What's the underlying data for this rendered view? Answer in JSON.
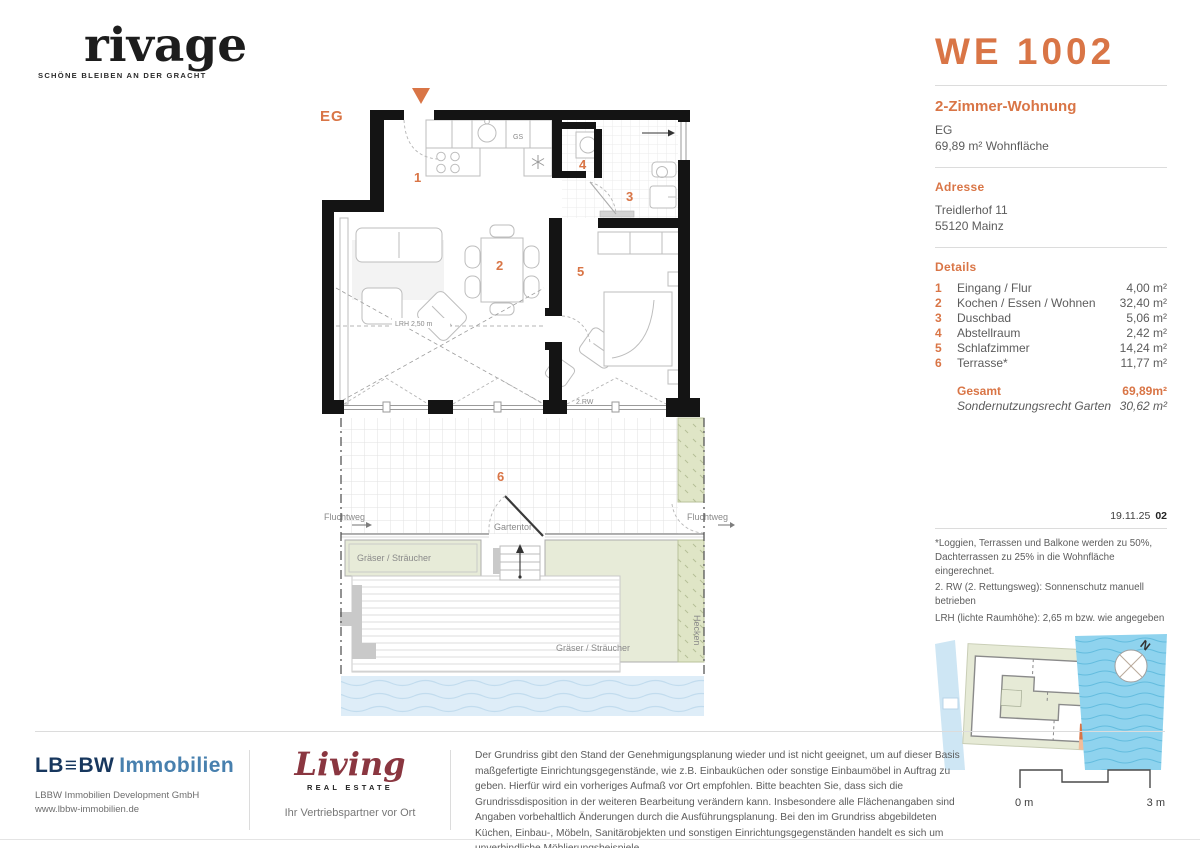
{
  "brand": {
    "name": "rivage",
    "tagline": "SCHÖNE BLEIBEN AN DER GRACHT"
  },
  "unit": {
    "id": "WE 1002",
    "type": "2-Zimmer-Wohnung",
    "floor": "EG",
    "area_line": "69,89 m² Wohnfläche"
  },
  "address": {
    "heading": "Adresse",
    "line1": "Treidlerhof 11",
    "line2": "55120 Mainz"
  },
  "details": {
    "heading": "Details",
    "rows": [
      {
        "num": "1",
        "name": "Eingang / Flur",
        "area": "4,00 m²"
      },
      {
        "num": "2",
        "name": "Kochen / Essen / Wohnen",
        "area": "32,40 m²"
      },
      {
        "num": "3",
        "name": "Duschbad",
        "area": "5,06 m²"
      },
      {
        "num": "4",
        "name": "Abstellraum",
        "area": "2,42 m²"
      },
      {
        "num": "5",
        "name": "Schlafzimmer",
        "area": "14,24 m²"
      },
      {
        "num": "6",
        "name": "Terrasse*",
        "area": "11,77 m²"
      }
    ],
    "total_label": "Gesamt",
    "total_value": "69,89m²",
    "special_label": "Sondernutzungsrecht Garten",
    "special_value": "30,62 m²"
  },
  "meta": {
    "date": "19.11.25",
    "revision": "02"
  },
  "footnotes": [
    "*Loggien, Terrassen und Balkone werden zu 50%, Dachterrassen zu 25% in die Wohnfläche eingerechnet.",
    "2. RW (2. Rettungsweg): Sonnenschutz manuell betrieben",
    "LRH (lichte Raumhöhe): 2,65 m bzw. wie angegeben"
  ],
  "plan": {
    "floor_label": "EG",
    "labels": {
      "lrh": "LRH 2,50 m",
      "rw": "2.RW",
      "gs": "GS",
      "fluchtweg_left": "Fluchtweg",
      "fluchtweg_right": "Fluchtweg",
      "gartentor": "Gartentor",
      "graeser_left": "Gräser / Sträucher",
      "graeser_right": "Gräser / Sträucher",
      "hecken": "Hecken",
      "north": "N"
    }
  },
  "footer": {
    "lbbw": {
      "logo_lb": "LB",
      "logo_eq": "≡",
      "logo_bw": "BW",
      "logo_suffix": "Immobilien",
      "line1": "LBBW Immobilien Development GmbH",
      "line2": "www.lbbw-immobilien.de"
    },
    "living": {
      "logo": "Living",
      "sub": "REAL ESTATE",
      "tagline": "Ihr Vertriebspartner vor Ort"
    },
    "disclaimer": "Der Grundriss gibt den Stand der Genehmigungsplanung wieder und ist nicht geeignet, um auf dieser Basis maßgefertigte Einrichtungsgegenstände, wie z.B. Einbauküchen oder sonstige Einbaumöbel in Auftrag zu geben. Hierfür wird ein vorheriges Aufmaß vor Ort empfohlen. Bitte beachten Sie, dass sich die Grundrissdisposition in der weiteren Bearbeitung verändern kann. Insbesondere alle Flächenangaben sind Angaben vorbehaltlich Änderungen durch die Ausführungsplanung. Bei den im Grundriss abgebildeten Küchen, Einbau-, Möbeln, Sanitärobjekten und sonstigen Einrichtungsgegenständen handelt es sich um unverbindliche Möblierungsbeispiele.",
    "scale": {
      "start": "0 m",
      "end": "3 m"
    }
  },
  "colors": {
    "accent": "#D97546",
    "navy": "#17375e",
    "lbbw_blue": "#4880ae",
    "wine": "#8a3640",
    "water_light": "#DEEDF8",
    "water_map": "#8FD3EE",
    "green": "#E7EBD8"
  }
}
